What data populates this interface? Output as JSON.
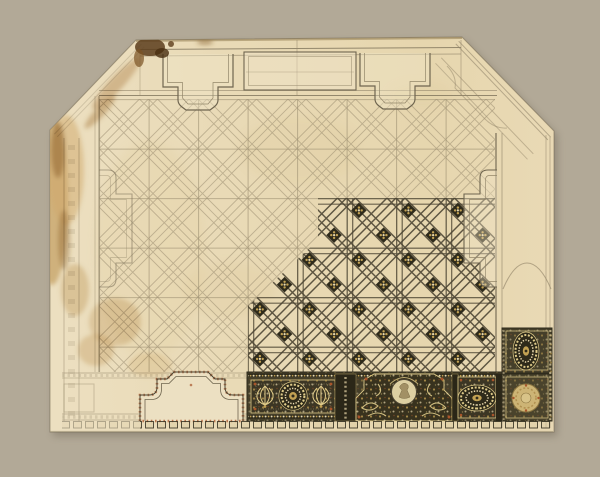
{
  "canvas": {
    "width": 600,
    "height": 477
  },
  "colors": {
    "background": "#b2a997",
    "shadow": "#6d6452",
    "paper": "#e9dab6",
    "paperLight": "#efe4c8",
    "paperDark": "#dfcda1",
    "pencil": "#93866a",
    "pencilDark": "#6f654f",
    "ink": "#4b4432",
    "inkDark": "#2f2b1c",
    "friezeGround": "#453f2a",
    "friezeDeep": "#2e2a1a",
    "bead": "#e6d9b4",
    "gold": "#c2a153",
    "goldLight": "#dfcb8a",
    "goldPale": "#cdb475",
    "red": "#a8552b",
    "stain": "#c5a166",
    "stainDark": "#8a5e2b",
    "crust": "#5c3d1c"
  },
  "scene": {
    "kind": "photograph of an ornamental ceiling design drawing on aged cream paper",
    "sheet_shape": "rectangle with chamfered upper corners",
    "field_pattern": "diagonal strapwork lattice, sketched in pencil at left and finished in dark ink with gilt rosettes at lower right",
    "bottom_frieze": "richly finished border band with gilt rosettes, oval paterae, palmettes and a figural medallion",
    "condition": "brown staining and losses along the left edge and upper left corner"
  },
  "motifs": {
    "top_cartouches": 2,
    "side_cartouches": 2,
    "bottom_cartouche": 1,
    "frieze_round_rosettes": 2,
    "frieze_oval_rosettes": 2,
    "figural_medallions": 1,
    "pale_corner_medallion": 1
  }
}
